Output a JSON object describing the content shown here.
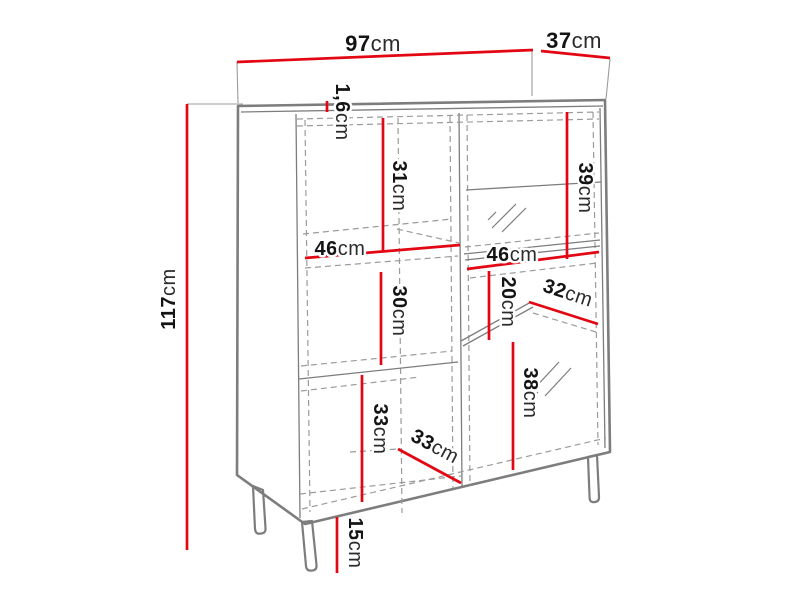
{
  "colors": {
    "dimension": "#e30613",
    "outline": "#7d7d7d",
    "outline_light": "#9b9b9b",
    "label_number": "#141414",
    "label_unit": "#2b2b2b"
  },
  "labels": {
    "top_width": {
      "num": "97",
      "unit": "cm"
    },
    "top_depth": {
      "num": "37",
      "unit": "cm"
    },
    "height": {
      "num": "117",
      "unit": "cm"
    },
    "top_thickness": {
      "num": "1,6",
      "unit": "cm"
    },
    "left_top_section": {
      "num": "31",
      "unit": "cm"
    },
    "left_shelf_width": {
      "num": "46",
      "unit": "cm"
    },
    "left_middle_section": {
      "num": "30",
      "unit": "cm"
    },
    "left_bottom_section": {
      "num": "33",
      "unit": "cm"
    },
    "left_bottom_depth": {
      "num": "33",
      "unit": "cm"
    },
    "right_top_section": {
      "num": "39",
      "unit": "cm"
    },
    "right_shelf_width": {
      "num": "46",
      "unit": "cm"
    },
    "right_middle_section": {
      "num": "20",
      "unit": "cm"
    },
    "right_shelf_depth": {
      "num": "32",
      "unit": "cm"
    },
    "right_bottom_section": {
      "num": "38",
      "unit": "cm"
    },
    "leg_height": {
      "num": "15",
      "unit": "cm"
    }
  }
}
